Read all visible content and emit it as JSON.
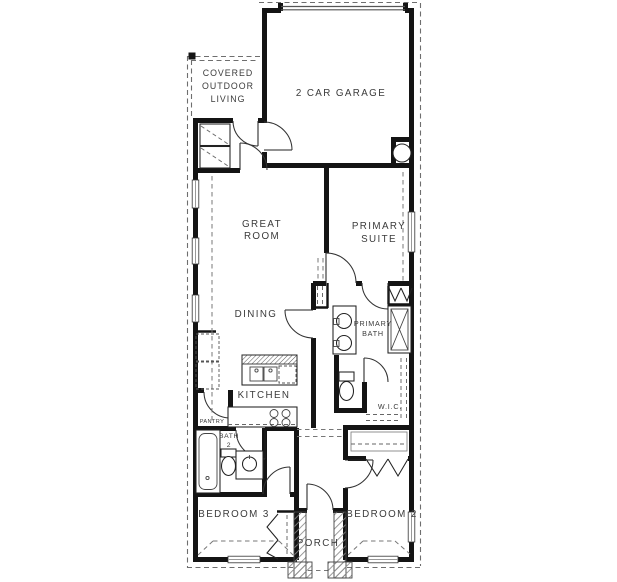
{
  "plan": {
    "labels": {
      "covered_outdoor_living": [
        "COVERED",
        "OUTDOOR",
        "LIVING"
      ],
      "garage": "2 CAR GARAGE",
      "great_room": [
        "GREAT",
        "ROOM"
      ],
      "primary_suite": [
        "PRIMARY",
        "SUITE"
      ],
      "dining": "DINING",
      "primary_bath": [
        "PRIMARY",
        "BATH"
      ],
      "kitchen": "KITCHEN",
      "wic": "W.I.C.",
      "pantry": "PANTRY",
      "bath2": [
        "BATH",
        "2"
      ],
      "bedroom3": "BEDROOM 3",
      "porch": "PORCH",
      "bedroom2": "BEDROOM 2"
    },
    "colors": {
      "wall": "#141414",
      "fixture_line": "#222222",
      "dashed_line": "#6e6e6e",
      "window": "#999999",
      "text": "#3b3b3b",
      "background": "#ffffff"
    },
    "fixtures": [
      "washer-dryer",
      "water-heater",
      "kitchen-island-double-sink",
      "dishwasher",
      "cooktop",
      "refrigerator",
      "double-vanity-sinks",
      "primary-toilet",
      "shower",
      "walk-in-closet-shelves",
      "bathtub",
      "bath2-toilet",
      "bath2-sink",
      "bedroom2-closet-bifold",
      "bedroom3-closet-bifold",
      "porch-columns"
    ]
  }
}
